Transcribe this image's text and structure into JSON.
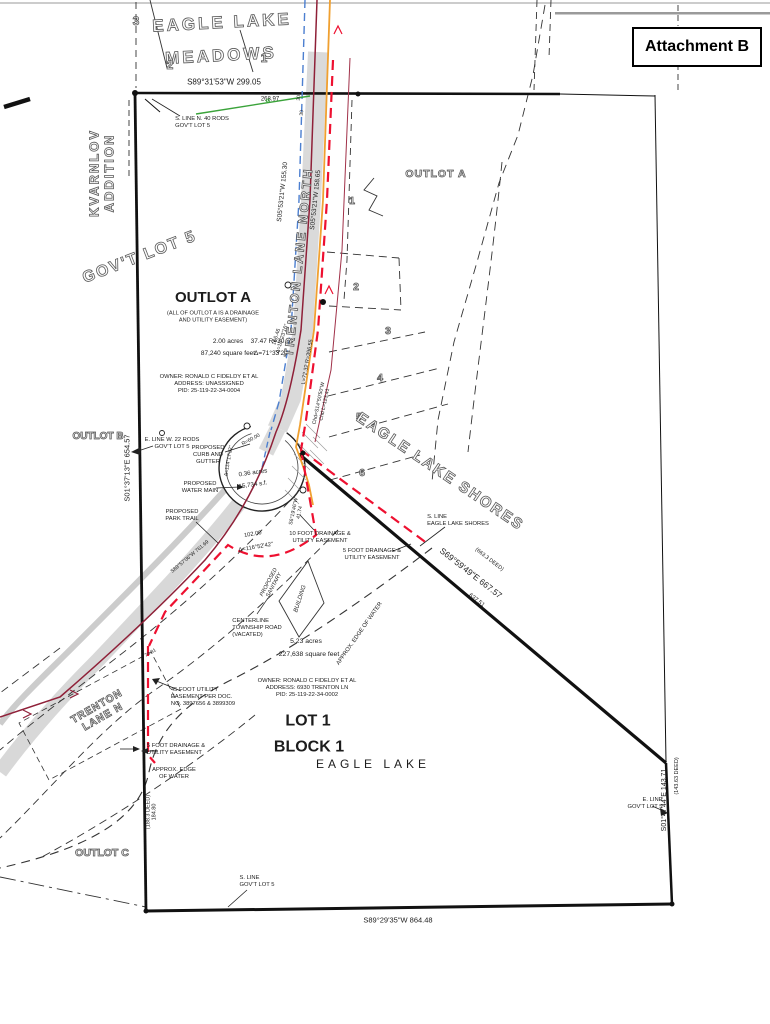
{
  "page": {
    "attachment_label": "Attachment B"
  },
  "colors": {
    "road_fill": "#dadada",
    "water_main_blue": "#4c7fd0",
    "centerline_maroon": "#8f2038",
    "easement_red": "#ee1030",
    "utility_orange": "#f0a030",
    "survey_green": "#3aa33a"
  },
  "labels": {
    "meadows_name_1": "EAGLE LAKE",
    "meadows_name_2": "MEADOWS",
    "meadows_lot_3": "3",
    "meadows_lot_2": "2",
    "meadows_lot_1": "1",
    "north_bearing": "S89°31'53\"W 299.05",
    "north_dist": "268.97",
    "s_line_n40": "S. LINE N. 40 RODS\nGOV'T LOT 5",
    "kvarnlov": "KVARNLOV\nADDITION",
    "govt_lot5": "GOV'T LOT 5",
    "outlot_b": "OUTLOT B",
    "west_bearing": "S01°37'13\"E  654.57",
    "outlot_a_title": "OUTLOT A",
    "outlot_a_note": "(ALL OF OUTLOT A IS A DRAINAGE\nAND UTILITY EASEMENT)",
    "outlot_a_acres": "2.00 acres",
    "outlot_a_sqft": "87,240 square feet",
    "curve_3747": "37.47  R=30.00",
    "curve_delta71": "Δ=71°33'24\"",
    "owner1": "OWNER: RONALD C FIDELDY ET AL\nADDRESS: UNASSIGNED\nPID: 25-119-22-34-0004",
    "outlot_a_right": "OUTLOT A",
    "shores_lot_1": "1",
    "shores_lot_2": "2",
    "shores_lot_3": "3",
    "shores_lot_4": "4",
    "shores_lot_5": "5",
    "shores_lot_6": "6",
    "eagle_lake_shores": "EAGLE LAKE SHORES",
    "trenton_lane_north": "TRENTON LANE NORTH",
    "road_bearing_left": "S05°53'21\"W  155.30",
    "road_bearing_right": "S05°53'21\"W  158.65",
    "curve_16646": "166.46\nΔ=10°23'16\"",
    "curve_r396": "L=72.32  R=396.55",
    "curve_chd": "Chd=S14°50'50\"W\nChd L=123.41",
    "rw30_a": "30",
    "rw30_b": "30",
    "e_line_w22": "E. LINE W. 22 RODS\nGOV'T LOT 5",
    "prop_curb": "PROPOSED\nCURB AND\nGUTTER",
    "prop_water": "PROPOSED\nWATER MAIN",
    "prop_trail": "PROPOSED\nPARK TRAIL",
    "bulb_acres": "0.36 acres",
    "bulb_sqft": "15,734 s.f.",
    "curve_r60": "R=60.00",
    "curve_delta114": "Δ=114°17'32\"",
    "dist_10200": "102.00",
    "delta_11652": "Δ=116°52'42\"",
    "bearing_41": "S6°19'46\"W\n41.74",
    "trail_bearing": "S89°57'06\"W  761.69",
    "easement_10": "10 FOOT DRAINAGE &\nUTILITY EASEMENT",
    "easement_5_right": "5 FOOT DRAINAGE &\nUTILITY EASEMENT",
    "s_line_shores": "S. LINE\nEAGLE LAKE SHORES",
    "diag_bearing": "S69°59'49\"E  667.57",
    "diag_deed": "(663.3 DEED)",
    "diag_dist2": "637.51",
    "prop_sanitary": "PROPOSED\nSANITARY",
    "building": "BUILDING",
    "centerline_road": "CENTERLINE\nTOWNSHIP ROAD\n(VACATED)",
    "lot1_acres": "5.23 acres",
    "lot1_sqft": "227,638 square feet",
    "edge_water_right": "APPROX. EDGE OF WATER",
    "owner2": "OWNER: RONALD C FIDELDY ET AL\nADDRESS: 6930 TRENTON LN\nPID: 25-119-22-34-0002",
    "lot1": "LOT 1",
    "block1": "BLOCK 1",
    "eagle_lake": "EAGLE LAKE",
    "easement_45": "45 FOOT UTILITY\nEASEMENT PER DOC.\nNO. 3897656 & 3899309",
    "easement_5_left": "5 FOOT DRAINAGE &\nUTILITY EASEMENT",
    "edge_water_left": "APPROX. EDGE\nOF WATER",
    "trenton_lane_n": "TRENTON\nLANE  N",
    "dist_7481": "74.81",
    "outlot_c": "OUTLOT C",
    "west_deed": "(188.3 DEED)\n184.80",
    "s_line_govt5": "S. LINE\nGOV'T LOT 5",
    "south_bearing": "S89°29'35\"W  864.48",
    "e_line_govt5": "E. LINE\nGOV'T LOT 5",
    "east_bearing": "S01°47'44\"E  143.71",
    "east_deed": "(143.63 DEED)",
    "green_arrows": "«"
  }
}
